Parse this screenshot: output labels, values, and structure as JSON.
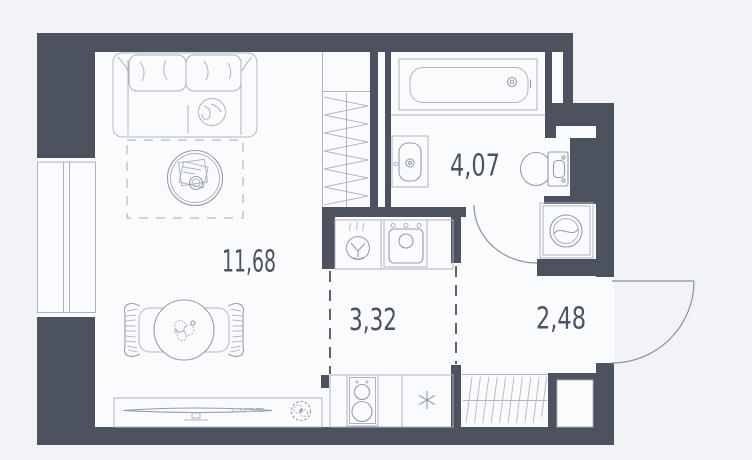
{
  "plan": {
    "title": "studio-apartment-floor-plan",
    "rooms": {
      "living": {
        "name": "living-room",
        "area_label": "11,68"
      },
      "kitchen": {
        "name": "kitchen-zone",
        "area_label": "3,32"
      },
      "bathroom": {
        "name": "bathroom",
        "area_label": "4,07"
      },
      "hallway": {
        "name": "hallway",
        "area_label": "2,48"
      }
    },
    "colors": {
      "background": "#f2f3f7",
      "floor": "#fafbfd",
      "wall": "#4d525f",
      "furniture_line_light": "#aeb3bf",
      "furniture_line_medium": "#969caa",
      "label_text": "#4d525f"
    },
    "icons": {
      "sofa": "sofa-icon",
      "coffee_table": "coffee-table-icon",
      "rug": "rug-outline",
      "dining_table": "dining-table-icon",
      "chairs": "chair-icon",
      "tv_stand": "tv-stand-icon",
      "plant": "plant-icon",
      "window": "window-icon",
      "closet": "closet-hatch-icon",
      "wardrobe": "wardrobe-hatch-icon",
      "round_sink": "round-sink-icon",
      "kitchen_sink": "kitchen-sink-icon",
      "stove": "stove-icon",
      "fridge_marker": "fridge-asterisk-icon",
      "bathtub": "bathtub-icon",
      "washbasin": "washbasin-icon",
      "toilet": "toilet-icon",
      "washing_machine": "washing-machine-icon",
      "bathroom_door": "bathroom-door-arc",
      "entrance_door": "entrance-door-arc"
    }
  }
}
